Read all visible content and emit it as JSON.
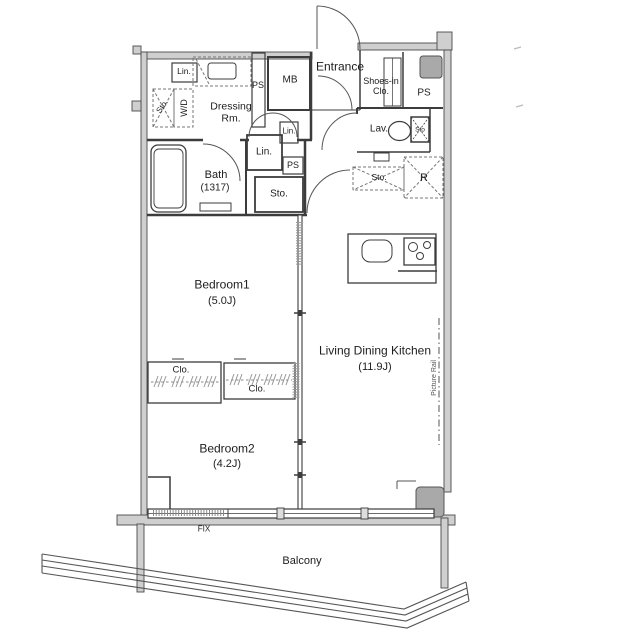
{
  "rooms": {
    "entrance": {
      "label": "Entrance"
    },
    "shoes_in_closet": {
      "label": "Shoes-in Clo."
    },
    "dressing_room": {
      "label": "Dressing Rm."
    },
    "bath": {
      "label": "Bath",
      "size": "(1317)"
    },
    "lavatory": {
      "label": "Lav."
    },
    "bedroom1": {
      "label": "Bedroom1",
      "size": "(5.0J)"
    },
    "bedroom2": {
      "label": "Bedroom2",
      "size": "(4.2J)"
    },
    "living_dining_kitchen": {
      "label": "Living Dining Kitchen",
      "size": "(11.9J)"
    },
    "balcony": {
      "label": "Balcony"
    }
  },
  "fixtures": {
    "linen": "Lin.",
    "pipe_space": "PS",
    "meter_box": "MB",
    "storage": "Sto.",
    "storage_short": "Sto",
    "washer_dryer": "W/D",
    "closet": "Clo.",
    "refrigerator": "R",
    "fixed_window": "FIX",
    "picture_rail": "Picture Rail"
  },
  "colors": {
    "wall_fill": "#cfcfcf",
    "pillar_fill": "#a9a9a9",
    "line": "#3c3c3c"
  }
}
